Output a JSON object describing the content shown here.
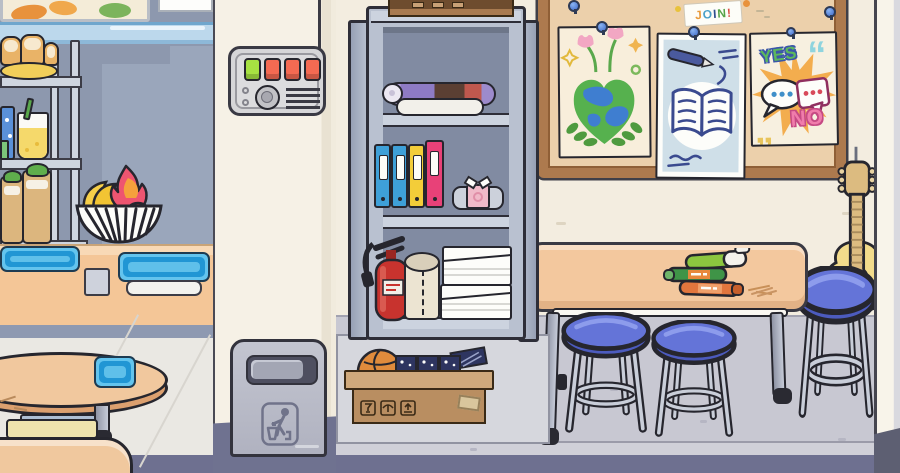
{
  "meta": {
    "app": "toca-world-style-game",
    "room": "school cafeteria and classroom",
    "canvas": {
      "w": 900,
      "h": 473
    }
  },
  "palette": {
    "outline": "#26262e",
    "wall_cream": "#f3ede0",
    "wall_blue": "#8d98ae",
    "wall_blue_light": "#9aa6bb",
    "floor_light": "#c8c8d2",
    "floor_dark": "#6e7090",
    "counter_peach": "#f4c697",
    "table_peach": "#f3c89e",
    "tray_blue": "#2ea7e0",
    "stool_blue": "#6474d8",
    "board_frame": "#ad7a4e",
    "board_surface": "#ecd0ab",
    "cabinet_metal": "#b9c1d0",
    "extinguisher_red": "#c8332e",
    "basketball_orange": "#e08b3c",
    "guitar_yellow": "#f2db8b"
  },
  "cafeteria": {
    "wall_art": "food-picture",
    "display_shelf": {
      "items": [
        "bread-loaf-plate",
        "star-soda-can",
        "lemonade-cup",
        "green-jar",
        "wrapped-sandwiches"
      ]
    },
    "fruit_basket": {
      "fruits": [
        "bananas",
        "dragonfruit",
        "apple",
        "limes"
      ]
    },
    "counter_items": [
      "blue-tray",
      "tray-stand",
      "blue-tray-on-base"
    ],
    "furniture": [
      "round-table-with-tray",
      "yellow-bench",
      "corner-table"
    ]
  },
  "control_panel": {
    "buttons": [
      {
        "color": "#a7e242"
      },
      {
        "color": "#f46a52"
      },
      {
        "color": "#f46a52"
      },
      {
        "color": "#f46a52"
      }
    ],
    "features": [
      "indicator-lights",
      "dial-knob",
      "speaker-grille",
      "wall-wire"
    ]
  },
  "trash_can": {
    "icon": "person-litter-icon"
  },
  "cabinet": {
    "top_item": "cardboard-box",
    "shelf_top": [
      "rolled-poster",
      "rolled-screen"
    ],
    "binders": [
      {
        "color": "#3ea0d8"
      },
      {
        "color": "#3ea0d8"
      },
      {
        "color": "#f3cd39"
      },
      {
        "color": "#e84178"
      }
    ],
    "shelf_middle": [
      "folded-shirt"
    ],
    "shelf_bottom": [
      "fire-extinguisher",
      "paper-towel-roll",
      "paper-stack",
      "paper-stack"
    ]
  },
  "moving_box": {
    "contents": [
      "basketball",
      "board-game-boxes"
    ],
    "markings": [
      "fragile-glass",
      "keep-dry-umbrella",
      "this-side-up-arrows"
    ],
    "tape": true
  },
  "board": {
    "join_sign": {
      "letters": [
        {
          "ch": "J",
          "color": "#e89a3c"
        },
        {
          "ch": "O",
          "color": "#4aa0c8"
        },
        {
          "ch": "I",
          "color": "#2f4f8f"
        },
        {
          "ch": "N",
          "color": "#55a348"
        },
        {
          "ch": "!",
          "color": "#d94f43"
        }
      ]
    },
    "posters": [
      {
        "name": "earth-heart-poster",
        "motifs": [
          "heart-shaped-earth",
          "tulips",
          "stars",
          "laurel-leaves"
        ]
      },
      {
        "name": "open-book-poster",
        "motifs": [
          "open-book",
          "pen",
          "squiggle-lines"
        ]
      },
      {
        "name": "yes-no-poster",
        "yes_text": "YES",
        "no_text": "NO",
        "motifs": [
          "orange-starburst",
          "speech-bubbles",
          "quote-marks"
        ]
      }
    ],
    "pin_count": 5
  },
  "classroom": {
    "table_items": [
      {
        "name": "green-pen",
        "color": "#8cc63f"
      },
      {
        "name": "green-marker",
        "color": "#3f9447"
      },
      {
        "name": "orange-marker",
        "color": "#e2763d"
      }
    ],
    "stools": [
      {
        "seat_color": "#6474d8"
      },
      {
        "seat_color": "#6474d8"
      },
      {
        "seat_color": "#6474d8"
      }
    ],
    "guitar": {
      "body_color": "#f2db8b",
      "strings": 6
    }
  }
}
